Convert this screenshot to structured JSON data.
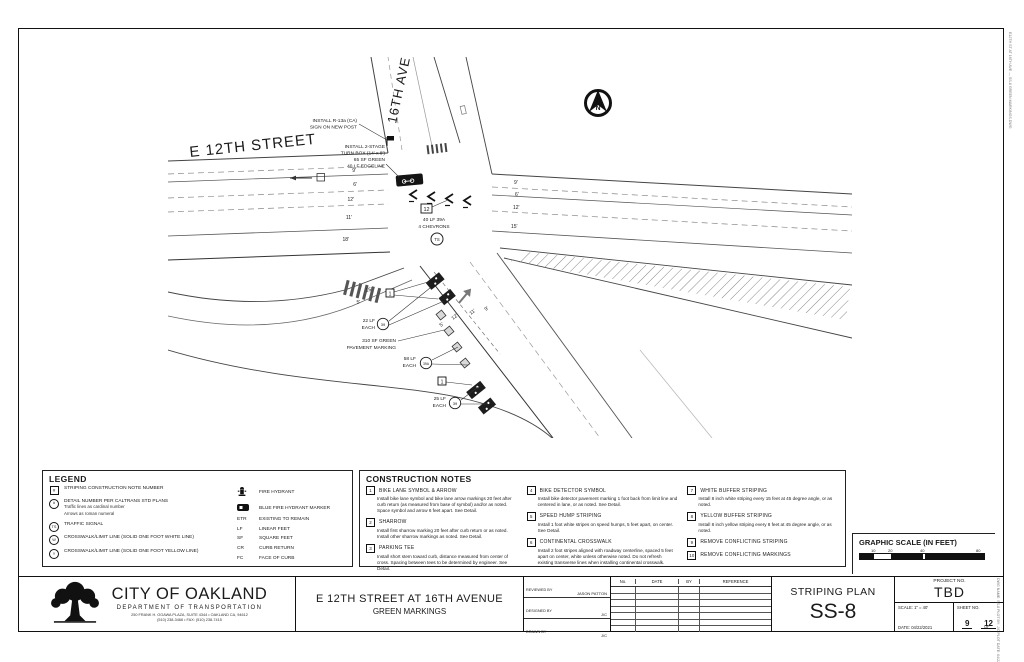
{
  "colors": {
    "ink": "#1a1a1a",
    "line": "#555555",
    "gray": "#999999"
  },
  "plan": {
    "street_label": "E 12TH STREET",
    "ave_label": "16TH AVE",
    "north_label": "N",
    "dims_left": [
      "9'",
      "6'",
      "12'",
      "11'",
      "18'"
    ],
    "dims_right": [
      "9'",
      "6'",
      "12'",
      "15'"
    ],
    "dims_diag": [
      "15'",
      "5'",
      "12'",
      "5'",
      "11'",
      "9'"
    ],
    "callouts": {
      "r13a": [
        "INSTALL R-13a (CA)",
        "SIGN ON NEW POST"
      ],
      "turnbox": [
        "INSTALL 2-STAGE",
        "TURN BOX (14' x 8')",
        "65 SF GREEN",
        "40 LF EDGELINE"
      ],
      "chevrons_note": {
        "num": "12",
        "line1": "40 LF 39A",
        "line2": "4 CHEVRONS"
      },
      "ts": "TS",
      "note1": "1",
      "q22": {
        "qty": "22 LF",
        "each": "EACH",
        "detail": "39"
      },
      "green_marking": [
        "310 SF GREEN",
        "PAVEMENT MARKING"
      ],
      "q58": {
        "qty": "58 LF",
        "each": "EACH",
        "detail": "39A"
      },
      "q25": {
        "qty": "25 LF",
        "each": "EACH",
        "detail": "39"
      }
    }
  },
  "legend": {
    "title": "LEGEND",
    "items": [
      {
        "symbol": "#",
        "label": "STRIPING CONSTRUCTION NOTE NUMBER"
      },
      {
        "symbol": "#",
        "label": "DETAIL NUMBER PER CALTRANS STD PLANS",
        "sub1": "Traffic lines as cardinal number",
        "sub2": "Arrows as roman numeral"
      },
      {
        "symbol": "TS",
        "label": "TRAFFIC SIGNAL"
      },
      {
        "symbol": "W",
        "label": "CROSSWALK/LIMIT LINE (SOLID ONE FOOT WHITE LINE)"
      },
      {
        "symbol": "Y",
        "label": "CROSSWALK/LIMIT LINE (SOLID ONE FOOT YELLOW LINE)"
      }
    ],
    "right_items": [
      {
        "abbr": "",
        "label": "FIRE HYDRANT"
      },
      {
        "abbr": "",
        "label": "BLUE FIRE HYDRANT MARKER"
      },
      {
        "abbr": "ETR",
        "label": "EXISTING TO REMAIN"
      },
      {
        "abbr": "LF",
        "label": "LINEAR FEET"
      },
      {
        "abbr": "SF",
        "label": "SQUARE FEET"
      },
      {
        "abbr": "CR",
        "label": "CURB RETURN"
      },
      {
        "abbr": "FC",
        "label": "FACE OF CURB"
      }
    ]
  },
  "construction_notes": {
    "title": "CONSTRUCTION NOTES",
    "notes": [
      {
        "num": "1",
        "title": "BIKE LANE SYMBOL & ARROW",
        "body": "Install bike lane symbol and bike lane arrow markings 20 feet after curb return (as measured from base of symbol) and/or as noted. Space symbol and arrow 6 feet apart. See Detail."
      },
      {
        "num": "2",
        "title": "SHARROW",
        "body": "Install first sharrow marking 20 feet after curb return or as noted. Install other sharrow markings as noted. See Detail."
      },
      {
        "num": "3",
        "title": "PARKING TEE",
        "body": "Install short stem toward curb, distance measured from center of cross. Spacing between tees to be determined by engineer. See Detail."
      },
      {
        "num": "4",
        "title": "BIKE DETECTOR SYMBOL",
        "body": "Install bike detector pavement marking 1 foot back from limit line and centered in lane, or as noted. See Detail."
      },
      {
        "num": "5",
        "title": "SPEED HUMP STRIPING",
        "body": "Install 1 foot white stripes on speed humps, 5 feet apart, on center.  See Detail."
      },
      {
        "num": "6",
        "title": "CONTINENTAL CROSSWALK",
        "body": "Install 2 foot stripes aligned with roadway centerline, spaced 5 feet apart on center, white unless otherwise noted. Do not refresh existing transverse lines when installing continental crosswalk."
      },
      {
        "num": "7",
        "title": "WHITE BUFFER STRIPING",
        "body": "Install 8 inch white striping every 15 feet at 45 degree angle, or as noted."
      },
      {
        "num": "8",
        "title": "YELLOW BUFFER STRIPING",
        "body": "Install 8 inch yellow striping every 8 feet at 45 degree angle, or as noted."
      },
      {
        "num": "9",
        "title": "REMOVE CONFLICTING STRIPING",
        "body": ""
      },
      {
        "num": "10",
        "title": "REMOVE CONFLICTING MARKINGS",
        "body": ""
      }
    ]
  },
  "graphic_scale": {
    "title": "GRAPHIC SCALE (IN FEET)",
    "ticks": [
      "10",
      "20",
      "40",
      "80"
    ]
  },
  "titleblock": {
    "agency": {
      "name": "CITY OF OAKLAND",
      "dept": "DEPARTMENT OF TRANSPORTATION",
      "addr1": "250 FRANK H. OGAWA PLAZA, SUITE 4344  •  OAKLAND CA, 94612",
      "addr2": "(510) 238-3466  •  FAX: (510) 238-7415"
    },
    "project_title": "E 12TH STREET AT 16TH AVENUE",
    "project_subtitle": "GREEN MARKINGS",
    "signoff": [
      {
        "label": "REVIEWED BY",
        "value": "JASON PATTON"
      },
      {
        "label": "DESIGNED BY",
        "value": "J/C"
      },
      {
        "label": "DRAWN BY",
        "value": "J/C"
      }
    ],
    "rev_headers": [
      "No.",
      "DATE",
      "BY",
      "REFERENCE"
    ],
    "plan_type": "STRIPING PLAN",
    "sheet_code": "SS-8",
    "project_no_label": "PROJECT NO.",
    "project_no": "TBD",
    "scale_label": "SCALE:",
    "scale": "1\" = 40'",
    "date_label": "DATE:",
    "date": "04/22/2021",
    "sheet_no_label": "SHEET NO.",
    "sheet_no": "9",
    "of_label": "OF",
    "sheet_total": "12"
  },
  "edge_stamps": {
    "top": "E12TH ST AT 16TH AVE — SS-8 GREEN MARKINGS.DWG",
    "bottom": "DWG NAME: SS-8   PLOT BY: J/C   PLOT DATE: 04/22/2021"
  }
}
